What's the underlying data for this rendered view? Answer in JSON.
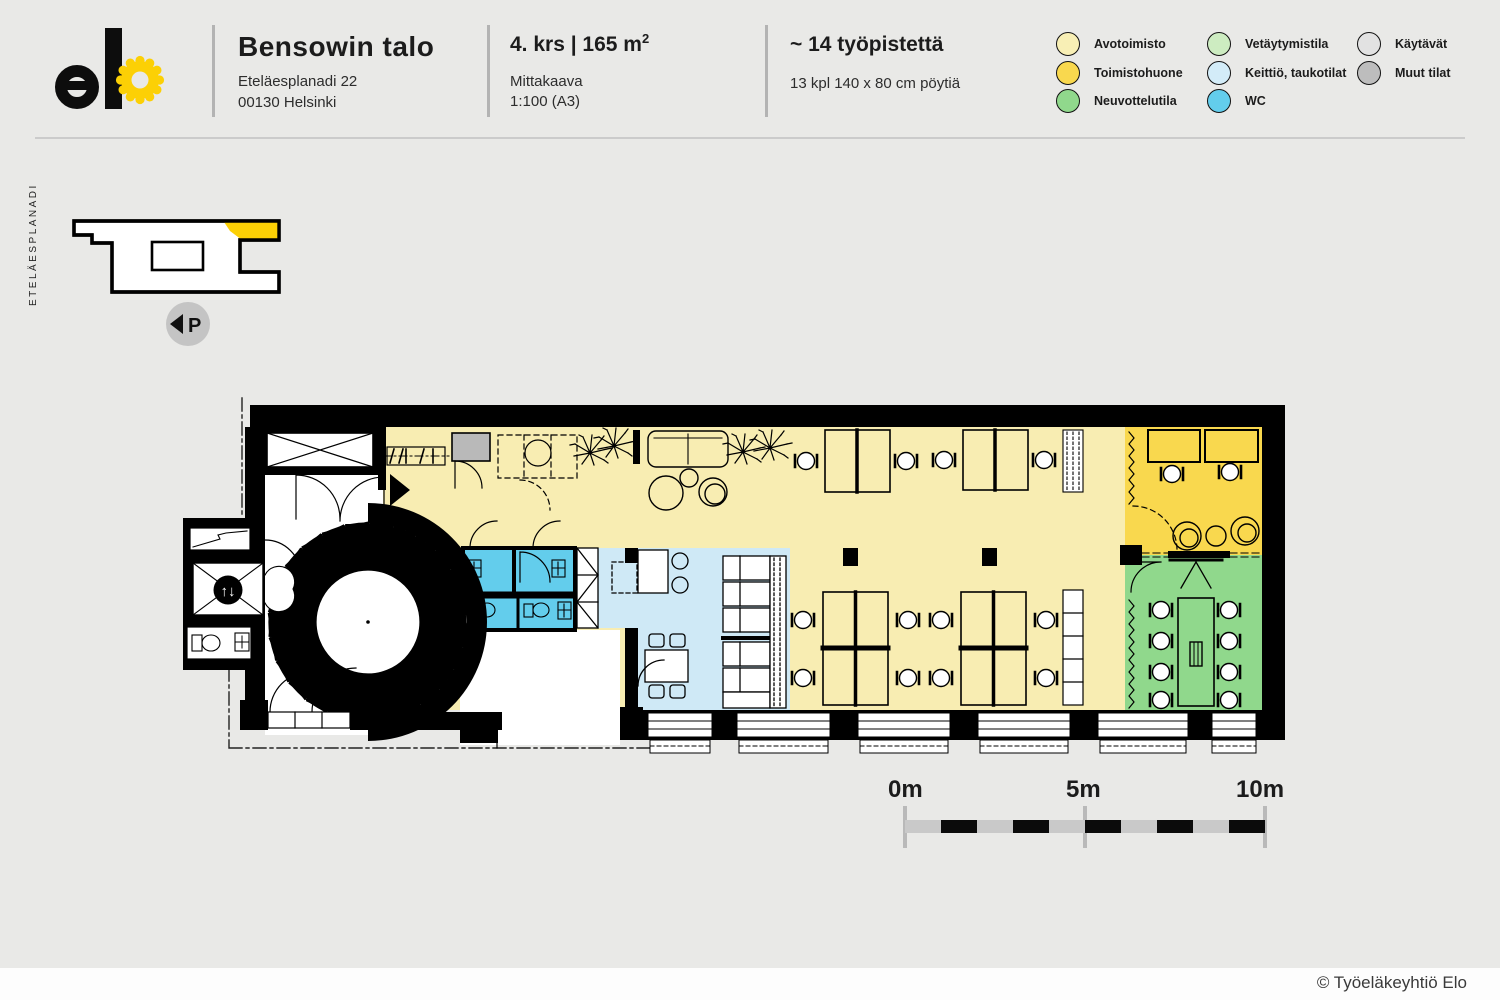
{
  "header": {
    "building_name": "Bensowin talo",
    "address_line1": "Eteläesplanadi 22",
    "address_line2": "00130 Helsinki",
    "floor_area_main": "4. krs | 165 m",
    "floor_area_sup": "2",
    "scale_label": "Mittakaava",
    "scale_value": "1:100 (A3)",
    "workstations": "~ 14 työpistettä",
    "tables_info": "13 kpl 140 x 80 cm pöytiä"
  },
  "legend": {
    "items": [
      {
        "label": "Avotoimisto",
        "color": "#f8efb5"
      },
      {
        "label": "Toimistohuone",
        "color": "#f9d84e"
      },
      {
        "label": "Neuvottelutila",
        "color": "#90d88c"
      },
      {
        "label": "Vetäytymistila",
        "color": "#cdecc1"
      },
      {
        "label": "Keittiö, taukotilat",
        "color": "#d3ecf8"
      },
      {
        "label": "WC",
        "color": "#63cdec"
      },
      {
        "label": "Käytävät",
        "color": "#e2e2e2"
      },
      {
        "label": "Muut tilat",
        "color": "#bdbdbd"
      }
    ]
  },
  "map": {
    "street_label": "ETELÄESPLANADI",
    "north_letter": "P"
  },
  "plan": {
    "building_letter": "B",
    "elevator_arrows": "↑↓"
  },
  "colors": {
    "open_office": "#f8edb2",
    "office_room": "#f9d84e",
    "meeting_room": "#90d88c",
    "kitchen": "#cfe9f6",
    "wc": "#63cdec",
    "other": "#b9b9b9",
    "brand_yellow": "#fcd005",
    "map_highlight": "#fcd005"
  },
  "scalebar": {
    "label_0": "0m",
    "label_5": "5m",
    "label_10": "10m"
  },
  "footer": {
    "copyright": "© Työeläkeyhtiö Elo"
  }
}
